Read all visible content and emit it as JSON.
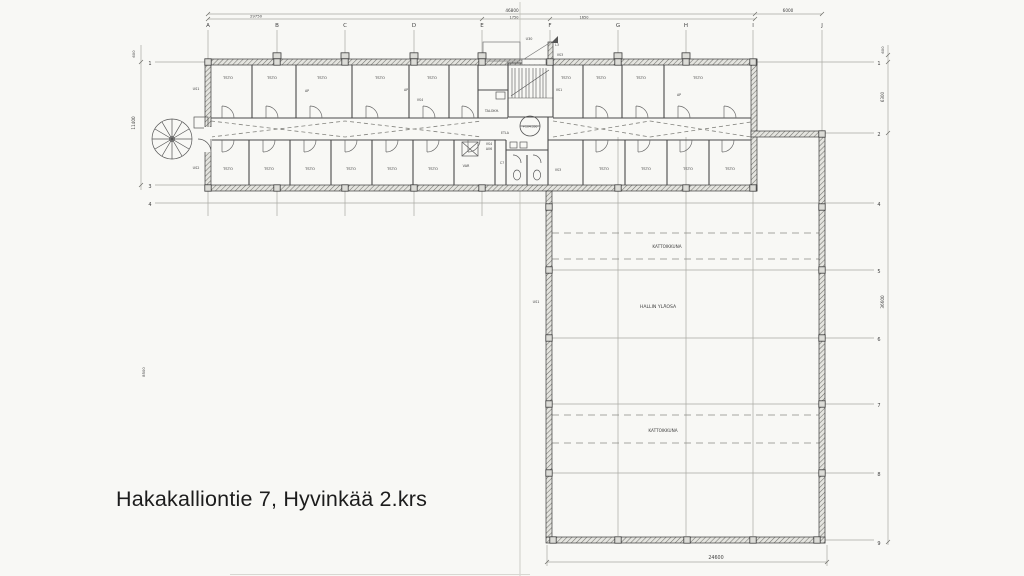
{
  "caption": "Hakakalliontie 7, Hyvinkää 2.krs",
  "colors": {
    "paper": "#f8f8f5",
    "ink": "#3f3f3f",
    "caption_text": "#1c1c1c"
  },
  "svg_texts": [
    {
      "n": "grid-letter-a",
      "t": "A",
      "x": 208,
      "y": 27,
      "s": 5.5
    },
    {
      "n": "grid-letter-b",
      "t": "B",
      "x": 277,
      "y": 27,
      "s": 5.5
    },
    {
      "n": "grid-letter-c",
      "t": "C",
      "x": 345,
      "y": 27,
      "s": 5.5
    },
    {
      "n": "grid-letter-d",
      "t": "D",
      "x": 414,
      "y": 27,
      "s": 5.5
    },
    {
      "n": "grid-letter-e",
      "t": "E",
      "x": 482,
      "y": 27,
      "s": 5.5
    },
    {
      "n": "grid-letter-f",
      "t": "F",
      "x": 550,
      "y": 27,
      "s": 5.5
    },
    {
      "n": "grid-letter-g",
      "t": "G",
      "x": 618,
      "y": 27,
      "s": 5.5
    },
    {
      "n": "grid-letter-h",
      "t": "H",
      "x": 686,
      "y": 27,
      "s": 5.5
    },
    {
      "n": "grid-letter-i",
      "t": "I",
      "x": 753,
      "y": 27,
      "s": 5.5
    },
    {
      "n": "grid-letter-j",
      "t": "J",
      "x": 822,
      "y": 27,
      "s": 5.5
    },
    {
      "n": "row-label-right-1",
      "t": "1",
      "x": 879,
      "y": 65,
      "s": 5
    },
    {
      "n": "row-label-right-2",
      "t": "2",
      "x": 879,
      "y": 136,
      "s": 5
    },
    {
      "n": "row-label-right-4",
      "t": "4",
      "x": 879,
      "y": 206,
      "s": 5
    },
    {
      "n": "row-label-right-5",
      "t": "5",
      "x": 879,
      "y": 273,
      "s": 5
    },
    {
      "n": "row-label-right-6",
      "t": "6",
      "x": 879,
      "y": 341,
      "s": 5
    },
    {
      "n": "row-label-right-7",
      "t": "7",
      "x": 879,
      "y": 407,
      "s": 5
    },
    {
      "n": "row-label-right-8",
      "t": "8",
      "x": 879,
      "y": 476,
      "s": 5
    },
    {
      "n": "row-label-right-9",
      "t": "9",
      "x": 879,
      "y": 545,
      "s": 5
    },
    {
      "n": "row-label-left-1",
      "t": "1",
      "x": 150,
      "y": 65,
      "s": 5
    },
    {
      "n": "row-label-left-3",
      "t": "3",
      "x": 150,
      "y": 188,
      "s": 5
    },
    {
      "n": "row-label-left-4",
      "t": "4",
      "x": 150,
      "y": 206,
      "s": 5
    },
    {
      "n": "dim-46800",
      "t": "46800",
      "x": 512,
      "y": 12,
      "s": 4.2
    },
    {
      "n": "dim-6000",
      "t": "6000",
      "x": 788,
      "y": 12,
      "s": 4.2
    },
    {
      "n": "dim-29750",
      "t": "29750",
      "x": 256,
      "y": 17.5,
      "s": 3.8
    },
    {
      "n": "dim-1750",
      "t": "1750",
      "x": 514,
      "y": 18.5,
      "s": 3.5
    },
    {
      "n": "dim-1650",
      "t": "1650",
      "x": 584,
      "y": 18.5,
      "s": 3.5
    },
    {
      "n": "dim-24600",
      "t": "24600",
      "x": 716,
      "y": 559,
      "s": 4.8
    },
    {
      "n": "dim-600-left",
      "t": "600",
      "x": 135,
      "y": 54,
      "s": 3.8,
      "r": -90
    },
    {
      "n": "dim-11400",
      "t": "11400",
      "x": 135,
      "y": 123,
      "s": 4.2,
      "r": -90
    },
    {
      "n": "dim-8500",
      "t": "8500",
      "x": 145,
      "y": 372,
      "s": 3.8,
      "r": -90
    },
    {
      "n": "dim-600-right",
      "t": "600",
      "x": 884,
      "y": 50,
      "s": 3.8,
      "r": -90
    },
    {
      "n": "dim-6300",
      "t": "6300",
      "x": 884,
      "y": 97,
      "s": 4,
      "r": -90
    },
    {
      "n": "dim-36600",
      "t": "36600",
      "x": 884,
      "y": 302,
      "s": 4.2,
      "r": -90
    },
    {
      "n": "hall-kattoikkuna-1",
      "t": "KATTOIKKUNA",
      "x": 667,
      "y": 248,
      "s": 4.2
    },
    {
      "n": "hall-hallin-ylaosa",
      "t": "HALLIN YLÄOSA",
      "x": 658,
      "y": 308,
      "s": 4.6
    },
    {
      "n": "hall-kattoikkuna-2",
      "t": "KATTOIKKUNA",
      "x": 663,
      "y": 432,
      "s": 4.2
    },
    {
      "n": "room-tsto-1",
      "t": "TSTO",
      "x": 228,
      "y": 79,
      "s": 3.8
    },
    {
      "n": "room-tsto-2",
      "t": "TSTO",
      "x": 272,
      "y": 79,
      "s": 3.8
    },
    {
      "n": "room-tsto-3",
      "t": "TSTO",
      "x": 322,
      "y": 79,
      "s": 3.8
    },
    {
      "n": "room-tsto-4",
      "t": "TSTO",
      "x": 380,
      "y": 79,
      "s": 3.8
    },
    {
      "n": "room-tsto-5",
      "t": "TSTO",
      "x": 432,
      "y": 79,
      "s": 3.8
    },
    {
      "n": "room-tsto-6",
      "t": "TSTO",
      "x": 566,
      "y": 79,
      "s": 3.8
    },
    {
      "n": "room-tsto-7",
      "t": "TSTO",
      "x": 601,
      "y": 79,
      "s": 3.8
    },
    {
      "n": "room-tsto-8",
      "t": "TSTO",
      "x": 641,
      "y": 79,
      "s": 3.8
    },
    {
      "n": "room-tsto-9",
      "t": "TSTO",
      "x": 698,
      "y": 79,
      "s": 3.8
    },
    {
      "n": "room-tsto-10",
      "t": "TSTO",
      "x": 228,
      "y": 170,
      "s": 3.8
    },
    {
      "n": "room-tsto-11",
      "t": "TSTO",
      "x": 269,
      "y": 170,
      "s": 3.8
    },
    {
      "n": "room-tsto-12",
      "t": "TSTO",
      "x": 310,
      "y": 170,
      "s": 3.8
    },
    {
      "n": "room-tsto-13",
      "t": "TSTO",
      "x": 351,
      "y": 170,
      "s": 3.8
    },
    {
      "n": "room-tsto-14",
      "t": "TSTO",
      "x": 392,
      "y": 170,
      "s": 3.8
    },
    {
      "n": "room-tsto-15",
      "t": "TSTO",
      "x": 433,
      "y": 170,
      "s": 3.8
    },
    {
      "n": "room-tsto-16",
      "t": "TSTO",
      "x": 604,
      "y": 170,
      "s": 3.8
    },
    {
      "n": "room-tsto-17",
      "t": "TSTO",
      "x": 646,
      "y": 170,
      "s": 3.8
    },
    {
      "n": "room-tsto-18",
      "t": "TSTO",
      "x": 688,
      "y": 170,
      "s": 3.8
    },
    {
      "n": "room-tsto-19",
      "t": "TSTO",
      "x": 730,
      "y": 170,
      "s": 3.8
    },
    {
      "n": "wall-tag-us1",
      "t": "US1",
      "x": 196,
      "y": 90,
      "s": 3.4
    },
    {
      "n": "wall-tag-us2",
      "t": "US2",
      "x": 196,
      "y": 169,
      "s": 3.4
    },
    {
      "n": "wall-tag-u30",
      "t": "U30",
      "x": 529,
      "y": 40,
      "s": 3.4
    },
    {
      "n": "wall-tag-l3",
      "t": "L3",
      "x": 557,
      "y": 46,
      "s": 3.2
    },
    {
      "n": "wall-tag-vs3-a",
      "t": "VS3",
      "x": 560,
      "y": 56,
      "s": 3.2
    },
    {
      "n": "wall-tag-vs1",
      "t": "VS1",
      "x": 559,
      "y": 91,
      "s": 3.2
    },
    {
      "n": "wall-tag-vs3-b",
      "t": "VS3",
      "x": 558,
      "y": 171,
      "s": 3.2
    },
    {
      "n": "room-talokh",
      "t": "TALOKH.",
      "x": 492,
      "y": 112,
      "s": 3.4
    },
    {
      "n": "room-etla",
      "t": "ETLA",
      "x": 505,
      "y": 134,
      "s": 3.2
    },
    {
      "n": "room-var",
      "t": "VAR",
      "x": 466,
      "y": 167,
      "s": 3.4
    },
    {
      "n": "tag-c7",
      "t": "C7",
      "x": 502,
      "y": 164,
      "s": 3.2
    },
    {
      "n": "wall-tag-vs4-a",
      "t": "VS4",
      "x": 489,
      "y": 145,
      "s": 3.2
    },
    {
      "n": "tag-a06",
      "t": "A06",
      "x": 489,
      "y": 150,
      "s": 3.2
    },
    {
      "n": "wall-tag-vs4-b",
      "t": "VS4",
      "x": 420,
      "y": 101,
      "s": 3.2
    },
    {
      "n": "tag-ap-1",
      "t": "AP",
      "x": 307,
      "y": 92,
      "s": 3.2
    },
    {
      "n": "tag-ap-2",
      "t": "AP",
      "x": 406,
      "y": 91,
      "s": 3.2
    },
    {
      "n": "tag-ap-3",
      "t": "AP",
      "x": 679,
      "y": 96,
      "s": 3.2
    },
    {
      "n": "wall-tag-us1-hall",
      "t": "US1",
      "x": 536,
      "y": 303,
      "s": 3.4
    },
    {
      "n": "elevation-marker",
      "t": "+104.350",
      "x": 530,
      "y": 127.5,
      "s": 3
    }
  ]
}
